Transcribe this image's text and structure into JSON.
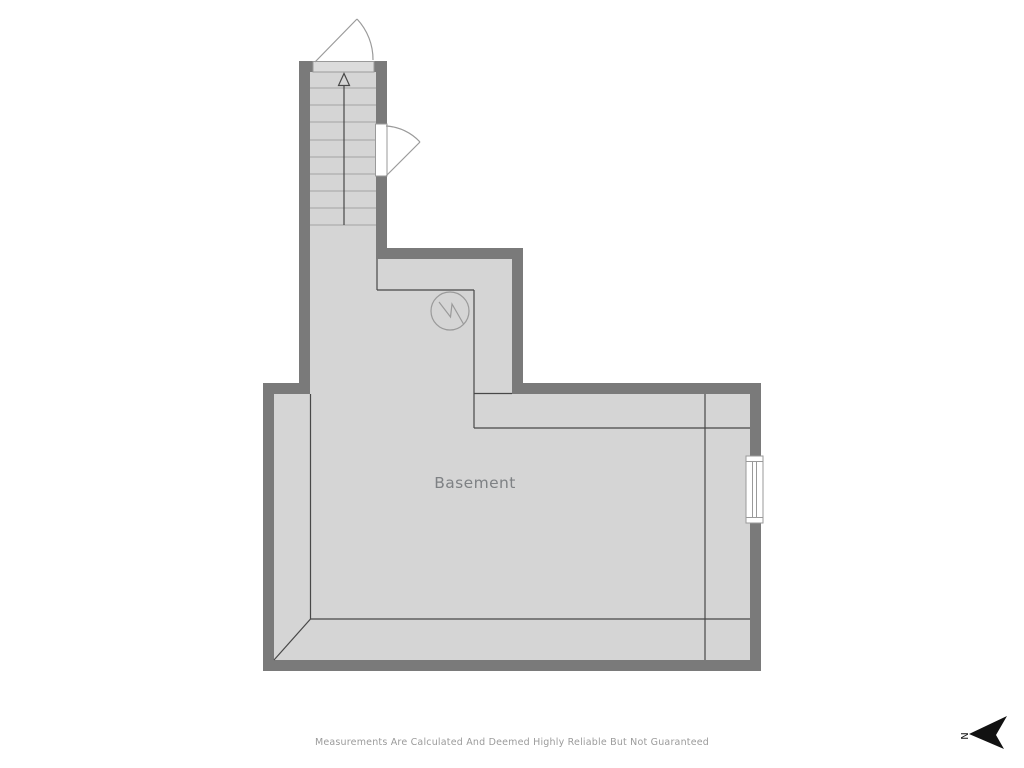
{
  "floor_plan": {
    "room": {
      "label": "Basement"
    },
    "stairs": {
      "direction_icon": "up-arrow-icon",
      "tread_lines": 9
    },
    "symbols": {
      "water_heater": "circle-zigzag-icon",
      "entry_door_top": "door-swing-arc",
      "side_door_right": "door-swing-arc",
      "window_right_wall": "double-line-window"
    },
    "compass": {
      "letter": "N",
      "pointing": "left",
      "icon": "north-dart-icon"
    },
    "footer": {
      "disclaimer": "Measurements Are Calculated And Deemed Highly Reliable But Not Guaranteed"
    },
    "colors": {
      "wall": "#7a7a7a",
      "floor": "#d5d5d5",
      "room_line": "#484848",
      "tread_line": "#a2a2a2",
      "symbol_stroke": "#9a9a9a",
      "room_label": "#7e8184",
      "disclaimer": "#9b9b9b",
      "compass": "#111111",
      "background": "#ffffff"
    }
  }
}
